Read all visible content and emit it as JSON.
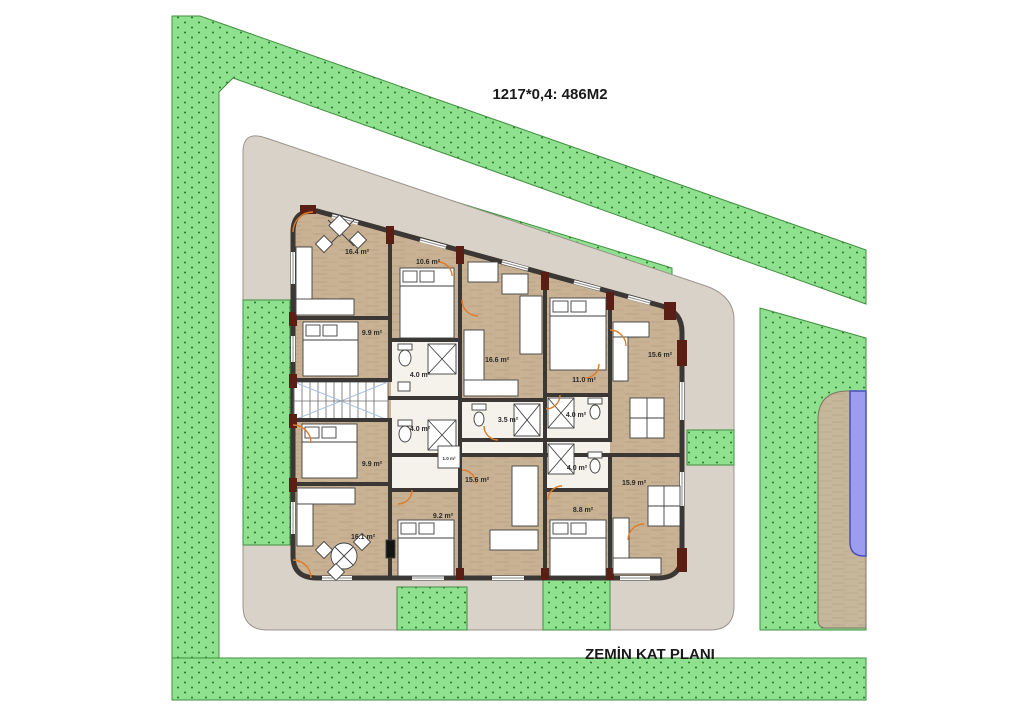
{
  "title": "1217*0,4: 486M2",
  "caption": "ZEMİN KAT PLANI",
  "colors": {
    "grass": "#8fe18f",
    "grass_dot": "#1e7a1e",
    "grass_border": "#3f8f3f",
    "pavement": "#d9d2c8",
    "pavement_border": "#9a948c",
    "floor": "#c9b294",
    "floor_streak": "#ab9272",
    "deck": "#c6b79c",
    "deck_streak": "#afa083",
    "wall": "#3b3734",
    "maroon": "#5a1f14",
    "pool": "#9d9df0",
    "pool_border": "#4d4dc0",
    "door": "#e07b28",
    "furniture_stroke": "#3f3f3f",
    "stair_hatch": "#a9c2e0",
    "label": "#2b2b2b",
    "table_green": "#8fbf9f",
    "title": "#1a1a1a"
  },
  "rooms": [
    {
      "name": "living-top-left",
      "area": "16.4 m²"
    },
    {
      "name": "bedroom-top-mid",
      "area": "10.6 m²"
    },
    {
      "name": "bedroom-upper-left",
      "area": "9.9 m²"
    },
    {
      "name": "bath-upper-left",
      "area": "4.0 m²"
    },
    {
      "name": "living-top-center",
      "area": "16.6 m²"
    },
    {
      "name": "bedroom-top-right",
      "area": "11.0 m²"
    },
    {
      "name": "living-top-far-right",
      "area": "15.6 m²"
    },
    {
      "name": "bath-center",
      "area": "3.5 m²"
    },
    {
      "name": "bath-upper-right",
      "area": "4.0 m²"
    },
    {
      "name": "bath-lower-left",
      "area": "4.0 m²"
    },
    {
      "name": "bath-lower-right",
      "area": "4.0 m²"
    },
    {
      "name": "bedroom-lower-left",
      "area": "9.9 m²"
    },
    {
      "name": "living-lower-center",
      "area": "15.6 m²"
    },
    {
      "name": "living-lower-right",
      "area": "15.9 m²"
    },
    {
      "name": "living-bottom-left",
      "area": "16.1 m²"
    },
    {
      "name": "bedroom-lower-mid",
      "area": "9.2 m²"
    },
    {
      "name": "bedroom-lower-right",
      "area": "8.8 m²"
    },
    {
      "name": "storage-closet",
      "area": "1.0 m²"
    }
  ]
}
